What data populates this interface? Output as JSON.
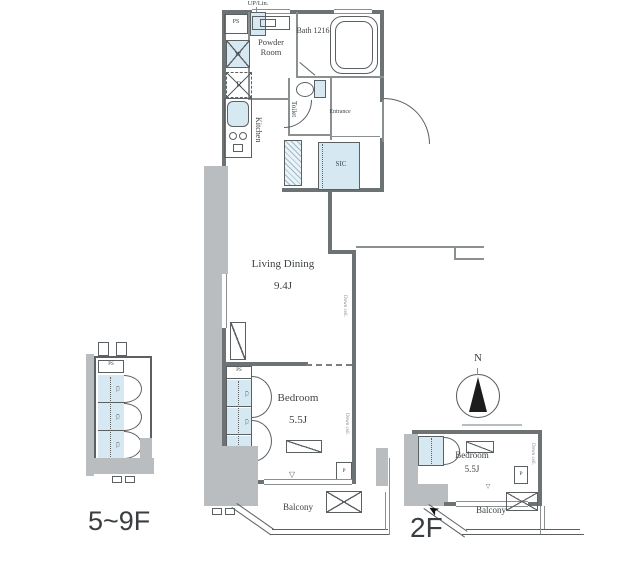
{
  "fp": {
    "main": {
      "up_lin": "UP/Lin.",
      "ps": "PS",
      "washer": "W",
      "powder_room": "Powder Room",
      "bath": "Bath 1216",
      "fridge": "R",
      "kitchen": "Kitchen",
      "toilet": "Toilet",
      "entrance": "Entrance",
      "sic": "SIC",
      "living": "Living Dining",
      "living_size": "9.4J",
      "closet": "Cl.",
      "closet_ps": "PS",
      "bedroom": "Bedroom",
      "bedroom_size": "5.5J",
      "pipe": "P",
      "balcony": "Balcony",
      "down_ceiling": "Down ceil.",
      "window_mark": "▽"
    },
    "upper": {
      "ps": "PS",
      "closet": "Cl.",
      "floor_label": "5~9F"
    },
    "second": {
      "bedroom": "Bedroom",
      "size": "5.5J",
      "pipe": "P",
      "balcony": "Balcony",
      "down_ceiling": "Down ceil.",
      "window_mark": "▽",
      "floor_label": "2F"
    },
    "compass_n": "N",
    "colors": {
      "wall": "#6d7275",
      "gray_fill": "#b9bdbf",
      "water_blue": "#d6e9f3",
      "text": "#3f4446"
    }
  }
}
